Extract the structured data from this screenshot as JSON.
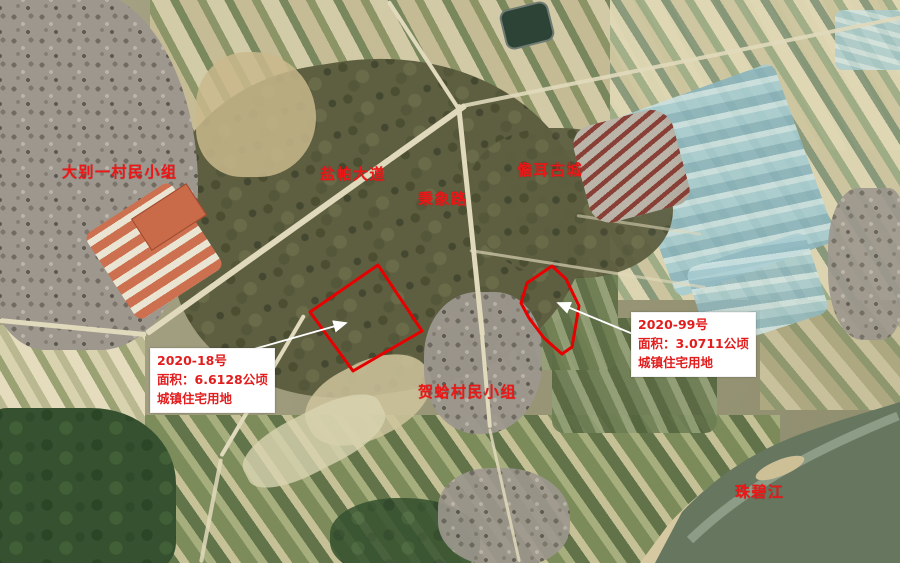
{
  "map": {
    "kind": "annotated satellite land-parcel map",
    "colors": {
      "annotation_red": "#ee1717",
      "callout_background": "#ffffff",
      "leader_line": "#ffffff",
      "parcel_outline": "#e60000"
    },
    "place_labels": {
      "village_top_left": "大别一村民小组",
      "avenue": "盐帕大道",
      "road": "秉象路",
      "ancient_town": "儋耳古城",
      "village_center": "贺蛤村民小组",
      "river": "珠碧江"
    },
    "parcels": [
      {
        "id": "2020-18",
        "title": "2020-18号",
        "area": "面积：6.6128公顷",
        "land_use": "城镇住宅用地",
        "outline_points": "378,265 422,331 353,371 310,312"
      },
      {
        "id": "2020-99",
        "title": "2020-99号",
        "area": "面积：3.0711公顷",
        "land_use": "城镇住宅用地",
        "outline_points": "552,266 566,279 579,306 572,347 562,354 544,338 529,318 521,303 527,283"
      }
    ]
  }
}
